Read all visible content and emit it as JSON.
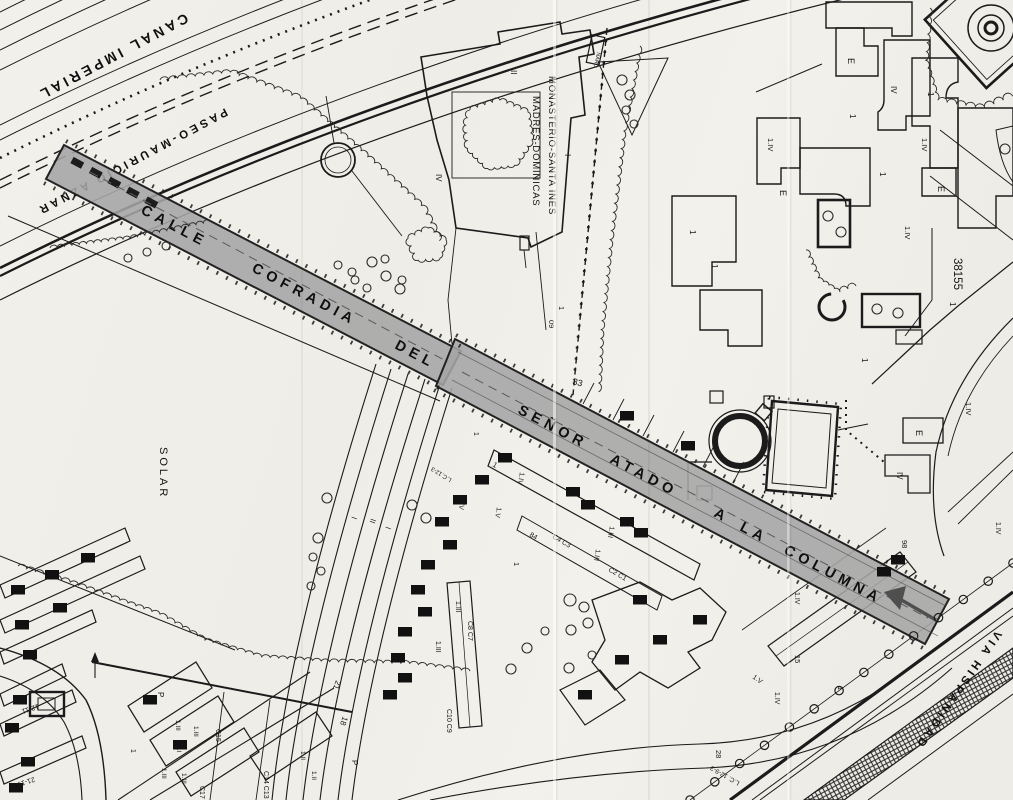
{
  "map": {
    "colors": {
      "paper": "#f1efea",
      "ink": "#1b1b1b",
      "highlight": "#a5a5a5",
      "arrow": "#4f4f4f"
    },
    "streets": {
      "canal": "CANAL IMPERIAL",
      "paseo": "PASEO-MAURICIO AZNAR",
      "via_hispanidad": "VIA HISPANIDAD",
      "calle_words": [
        {
          "t": "CALLE",
          "x": 140,
          "y": 213
        },
        {
          "t": "COFRADIA",
          "x": 251,
          "y": 271
        },
        {
          "t": "DEL",
          "x": 394,
          "y": 348
        }
      ],
      "senor_words": [
        {
          "t": "SEÑOR",
          "x": 517,
          "y": 413
        },
        {
          "t": "ATADO",
          "x": 609,
          "y": 462
        },
        {
          "t": "A",
          "x": 713,
          "y": 516
        },
        {
          "t": "LA",
          "x": 739,
          "y": 530
        },
        {
          "t": "COLUMNA",
          "x": 783,
          "y": 553
        }
      ]
    },
    "places": {
      "monastery_line1": "MONASTERIO-SANTA INES",
      "monastery_line2": "MADRES-DOMINICAS",
      "solar": "SOLAR",
      "parcel_number": "38155"
    },
    "labels": [
      {
        "t": "E",
        "x": 848,
        "y": 58,
        "r": 90,
        "s": 9
      },
      {
        "t": "IV",
        "x": 891,
        "y": 86,
        "r": 90,
        "s": 8
      },
      {
        "t": "1",
        "x": 928,
        "y": 92,
        "r": 90,
        "s": 8
      },
      {
        "t": "1",
        "x": 850,
        "y": 114,
        "r": 90,
        "s": 8
      },
      {
        "t": "1.IV",
        "x": 922,
        "y": 138,
        "r": 90,
        "s": 7.5
      },
      {
        "t": "E",
        "x": 938,
        "y": 186,
        "r": 90,
        "s": 9
      },
      {
        "t": "1.IV",
        "x": 768,
        "y": 138,
        "r": 90,
        "s": 7.5
      },
      {
        "t": "E",
        "x": 780,
        "y": 190,
        "r": 90,
        "s": 9
      },
      {
        "t": "1",
        "x": 880,
        "y": 172,
        "r": 90,
        "s": 8
      },
      {
        "t": "1.IV",
        "x": 905,
        "y": 226,
        "r": 90,
        "s": 7.5
      },
      {
        "t": "1",
        "x": 690,
        "y": 230,
        "r": 90,
        "s": 8
      },
      {
        "t": "1",
        "x": 712,
        "y": 264,
        "r": 90,
        "s": 8
      },
      {
        "t": "38155",
        "x": 954,
        "y": 258,
        "r": 90,
        "s": 11.5
      },
      {
        "t": "1",
        "x": 950,
        "y": 302,
        "r": 90,
        "s": 8
      },
      {
        "t": "1",
        "x": 862,
        "y": 358,
        "r": 90,
        "s": 8
      },
      {
        "t": "1.IV",
        "x": 966,
        "y": 402,
        "r": 90,
        "s": 7.5
      },
      {
        "t": "E",
        "x": 916,
        "y": 430,
        "r": 90,
        "s": 9
      },
      {
        "t": "IV",
        "x": 897,
        "y": 472,
        "r": 90,
        "s": 8
      },
      {
        "t": "1.IV",
        "x": 996,
        "y": 522,
        "r": 90,
        "s": 7
      },
      {
        "t": "98",
        "x": 902,
        "y": 540,
        "r": 90,
        "s": 7.5
      },
      {
        "t": "1.IV",
        "x": 795,
        "y": 592,
        "r": 90,
        "s": 7
      },
      {
        "t": "15",
        "x": 795,
        "y": 655,
        "r": 90,
        "s": 7.5
      },
      {
        "t": "1.IV",
        "x": 775,
        "y": 692,
        "r": 90,
        "s": 7
      },
      {
        "t": "1.V",
        "x": 752,
        "y": 678,
        "r": 35,
        "s": 7
      },
      {
        "t": "28",
        "x": 716,
        "y": 750,
        "r": 90,
        "s": 7.5
      },
      {
        "t": "L.C. 12-9-3",
        "x": 740,
        "y": 782,
        "r": 210,
        "s": 6.5
      },
      {
        "t": "1",
        "x": 838,
        "y": 686,
        "r": 90,
        "s": 7.5
      },
      {
        "t": "II",
        "x": 511,
        "y": 70,
        "r": 90,
        "s": 8
      },
      {
        "t": "IV",
        "x": 436,
        "y": 174,
        "r": 90,
        "s": 8
      },
      {
        "t": "I",
        "x": 565,
        "y": 154,
        "r": 90,
        "s": 8
      },
      {
        "t": "NARD",
        "x": 597,
        "y": 52,
        "r": 102,
        "s": 5.5
      },
      {
        "t": "1",
        "x": 559,
        "y": 306,
        "r": 90,
        "s": 7.5
      },
      {
        "t": "09",
        "x": 549,
        "y": 320,
        "r": 90,
        "s": 7.5
      },
      {
        "t": "33",
        "x": 572,
        "y": 384,
        "r": 15,
        "s": 9
      },
      {
        "t": "1",
        "x": 474,
        "y": 432,
        "r": 90,
        "s": 7
      },
      {
        "t": "1.IV",
        "x": 520,
        "y": 472,
        "r": 100,
        "s": 7
      },
      {
        "t": "1.IV",
        "x": 461,
        "y": 497,
        "r": 100,
        "s": 7
      },
      {
        "t": "1.V",
        "x": 497,
        "y": 507,
        "r": 100,
        "s": 7
      },
      {
        "t": "1",
        "x": 492,
        "y": 466,
        "r": 30,
        "s": 7.5
      },
      {
        "t": "L.C.12-3",
        "x": 452,
        "y": 479,
        "r": 212,
        "s": 6
      },
      {
        "t": "84",
        "x": 529,
        "y": 536,
        "r": 30,
        "s": 7
      },
      {
        "t": "C4 C3",
        "x": 552,
        "y": 538,
        "r": 30,
        "s": 7
      },
      {
        "t": "C2 C1",
        "x": 608,
        "y": 571,
        "r": 30,
        "s": 7
      },
      {
        "t": "1.III",
        "x": 596,
        "y": 549,
        "r": 100,
        "s": 7
      },
      {
        "t": "1.III",
        "x": 610,
        "y": 526,
        "r": 100,
        "s": 7
      },
      {
        "t": "1",
        "x": 514,
        "y": 562,
        "r": 90,
        "s": 7.5
      },
      {
        "t": "C8 C7",
        "x": 468,
        "y": 621,
        "r": 90,
        "s": 7
      },
      {
        "t": "1.III",
        "x": 456,
        "y": 601,
        "r": 90,
        "s": 7
      },
      {
        "t": "C10 C9",
        "x": 447,
        "y": 709,
        "r": 90,
        "s": 7
      },
      {
        "t": "1.III",
        "x": 436,
        "y": 641,
        "r": 90,
        "s": 7
      },
      {
        "t": "I",
        "x": 352,
        "y": 516,
        "r": 110,
        "s": 8
      },
      {
        "t": "II",
        "x": 371,
        "y": 518,
        "r": 110,
        "s": 8
      },
      {
        "t": "I",
        "x": 386,
        "y": 526,
        "r": 110,
        "s": 8
      },
      {
        "t": "21",
        "x": 336,
        "y": 680,
        "r": 110,
        "s": 8
      },
      {
        "t": "18",
        "x": 343,
        "y": 716,
        "r": 110,
        "s": 8
      },
      {
        "t": "P",
        "x": 158,
        "y": 692,
        "r": 90,
        "s": 8
      },
      {
        "t": "P",
        "x": 352,
        "y": 760,
        "r": 90,
        "s": 8
      },
      {
        "t": "1.III",
        "x": 176,
        "y": 720,
        "r": 90,
        "s": 6.5
      },
      {
        "t": "1.III",
        "x": 194,
        "y": 726,
        "r": 90,
        "s": 6.5
      },
      {
        "t": "1.I",
        "x": 177,
        "y": 745,
        "r": 90,
        "s": 6.5
      },
      {
        "t": "1.III",
        "x": 162,
        "y": 768,
        "r": 90,
        "s": 6.5
      },
      {
        "t": "1.III",
        "x": 182,
        "y": 773,
        "r": 90,
        "s": 6.5
      },
      {
        "t": "1.II",
        "x": 301,
        "y": 751,
        "r": 90,
        "s": 6.5
      },
      {
        "t": "1.II",
        "x": 312,
        "y": 771,
        "r": 90,
        "s": 6.5
      },
      {
        "t": "C15",
        "x": 216,
        "y": 729,
        "r": 90,
        "s": 7
      },
      {
        "t": "C17 C16",
        "x": 200,
        "y": 786,
        "r": 90,
        "s": 7
      },
      {
        "t": "C14 C13",
        "x": 264,
        "y": 771,
        "r": 90,
        "s": 7
      },
      {
        "t": "12-11",
        "x": 38,
        "y": 704,
        "r": 162,
        "s": 7
      },
      {
        "t": "21-19",
        "x": 34,
        "y": 777,
        "r": 162,
        "s": 7
      },
      {
        "t": "1",
        "x": 131,
        "y": 749,
        "r": 90,
        "s": 7
      }
    ]
  }
}
